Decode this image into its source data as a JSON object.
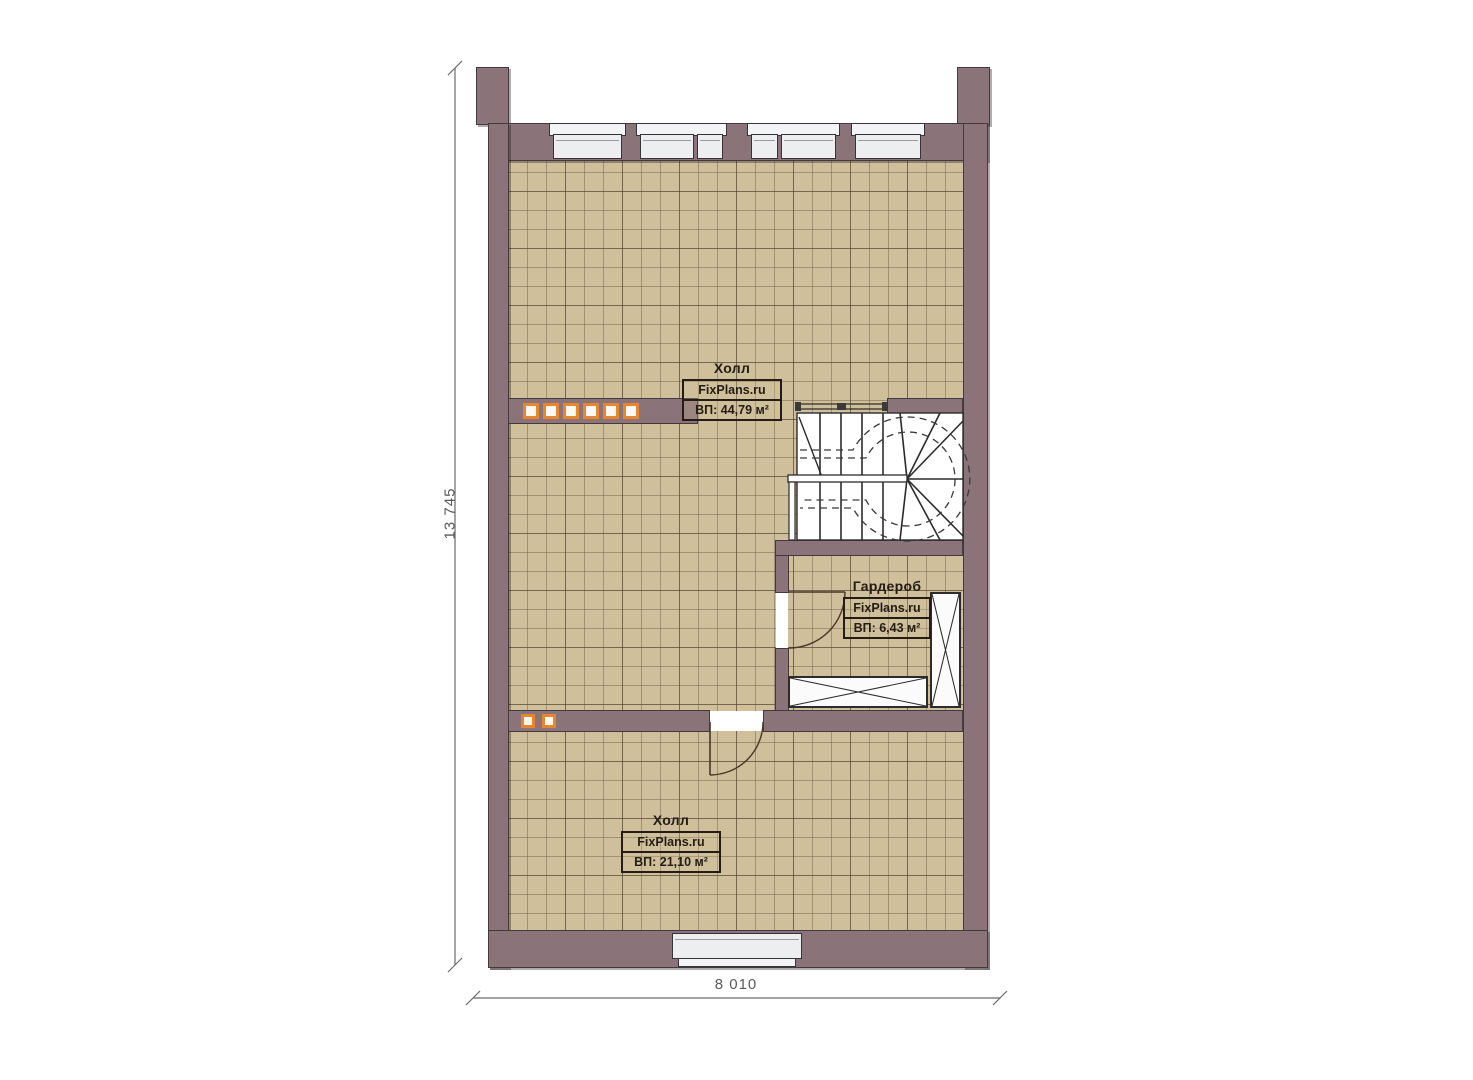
{
  "plan": {
    "dimension_height": "13 745",
    "dimension_width": "8 010",
    "rooms": [
      {
        "name": "Холл",
        "watermark": "FixPlans.ru",
        "area": "ВП: 44,79 м²"
      },
      {
        "name": "Гардероб",
        "watermark": "FixPlans.ru",
        "area": "ВП: 6,43 м²"
      },
      {
        "name": "Холл",
        "watermark": "FixPlans.ru",
        "area": "ВП: 21,10 м²"
      }
    ],
    "colors": {
      "wall": "#8b737a",
      "wall_outline": "#453940",
      "floor": "#cfc09b",
      "floor_grid": "#7d6c4e",
      "glass_block_accent": "#e9842f",
      "window_fill": "#eceef0",
      "stair_fill": "#ffffff",
      "dimension_line": "#5a5a5a",
      "label_ink": "#241c15"
    }
  }
}
